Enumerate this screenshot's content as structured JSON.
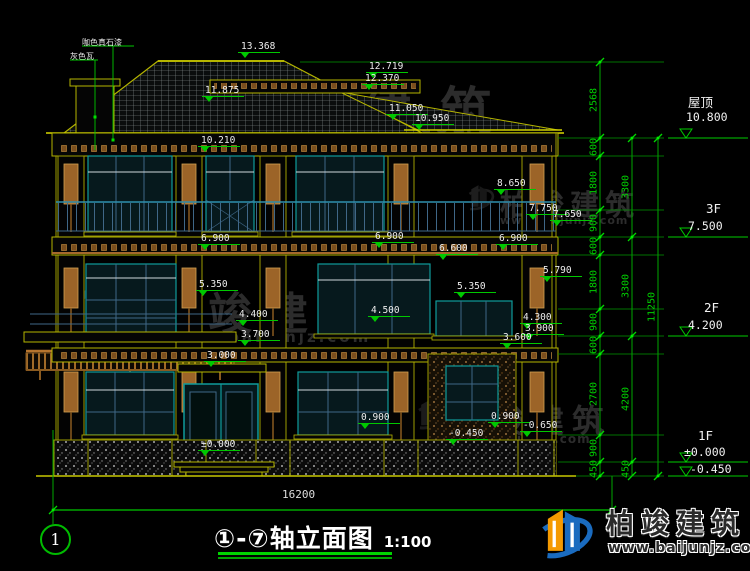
{
  "materials": [
    "咖色真石漆",
    "灰色瓦"
  ],
  "elev": [
    "13.368",
    "12.719",
    "12.370",
    "11.875",
    "11.050",
    "10.950",
    "10.210",
    "8.650",
    "7.750",
    "7.650",
    "6.900",
    "6.900",
    "6.900",
    "6.600",
    "5.790",
    "5.350",
    "5.350",
    "4.400",
    "4.500",
    "4.300",
    "3.900",
    "3.600",
    "3.700",
    "3.000",
    "0.900",
    "0.900",
    "-0.650",
    "-0.450",
    "±0.000"
  ],
  "levels": {
    "roof": {
      "name": "屋顶",
      "value": "10.800"
    },
    "f3": {
      "name": "3F",
      "value": "7.500"
    },
    "f2": {
      "name": "2F",
      "value": "4.200"
    },
    "f1": {
      "name": "1F",
      "value": "±0.000"
    },
    "ground": {
      "value": "-0.450"
    }
  },
  "dims": {
    "chain1": [
      "2568",
      "600",
      "1800",
      "900",
      "600",
      "1800",
      "900",
      "600",
      "2700",
      "900",
      "450"
    ],
    "chain2": [
      "3300",
      "3300",
      "4200",
      "450"
    ],
    "chain3": [
      "11250"
    ],
    "overall": "16200"
  },
  "footer": {
    "axis_number": "1",
    "title": "①-⑦轴立面图",
    "scale": "1:100"
  },
  "brand": {
    "name": "柏竣建筑",
    "url": "www.baijunjz.com"
  },
  "colors": {
    "dim_green": "#00c800",
    "wall_yellow": "#b5b500",
    "window_teal": "#0f9b9b",
    "brown": "#9c6428",
    "logo_blue": "#1a6bbf",
    "logo_orange": "#f59a00"
  }
}
